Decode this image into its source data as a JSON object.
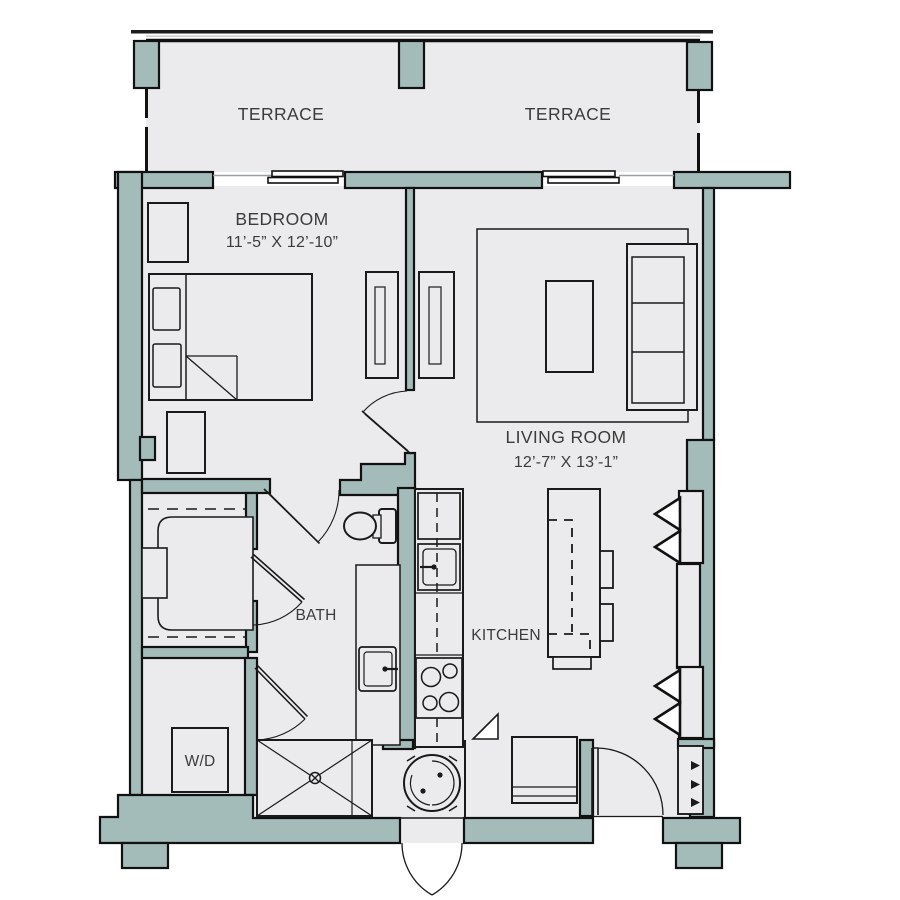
{
  "plan": {
    "title": "One-bedroom apartment floor plan",
    "labels": {
      "terrace_left": "TERRACE",
      "terrace_right": "TERRACE",
      "bedroom_name": "BEDROOM",
      "bedroom_dims": "11’-5” X 12’-10”",
      "living_name": "LIVING ROOM",
      "living_dims": "12’-7” X 13’-1”",
      "kitchen": "KITCHEN",
      "bath": "BATH",
      "washer_dryer": "W/D"
    },
    "rooms": [
      {
        "name": "Terrace (left)"
      },
      {
        "name": "Terrace (right)"
      },
      {
        "name": "Bedroom",
        "dimensions": "11'-5\" x 12'-10\""
      },
      {
        "name": "Living Room",
        "dimensions": "12'-7\" x 13'-1\""
      },
      {
        "name": "Kitchen"
      },
      {
        "name": "Bath"
      },
      {
        "name": "Walk-in closet"
      },
      {
        "name": "W/D closet"
      }
    ],
    "colors": {
      "wall": "#a3bcb9",
      "floor": "#ebebed",
      "line": "#1a1a1a",
      "text": "#3b3b3b",
      "opening": "#9aa0a3"
    }
  }
}
